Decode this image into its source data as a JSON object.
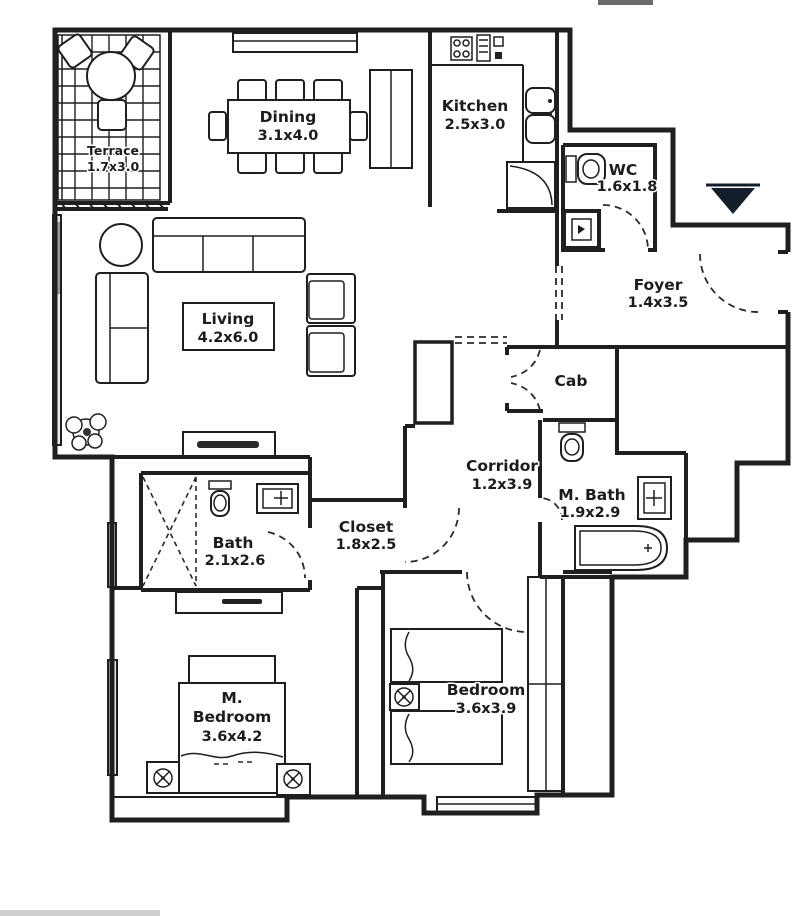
{
  "plan_title": "Apartment floor plan",
  "rooms": {
    "terrace": {
      "name": "Terrace",
      "dims": "1.7x3.0"
    },
    "dining": {
      "name": "Dining",
      "dims": "3.1x4.0"
    },
    "kitchen": {
      "name": "Kitchen",
      "dims": "2.5x3.0"
    },
    "wc": {
      "name": "WC",
      "dims": "1.6x1.8"
    },
    "foyer": {
      "name": "Foyer",
      "dims": "1.4x3.5"
    },
    "living": {
      "name": "Living",
      "dims": "4.2x6.0"
    },
    "cab": {
      "name": "Cab"
    },
    "corridor": {
      "name": "Corridor",
      "dims": "1.2x3.9"
    },
    "master_bath": {
      "name": "M. Bath",
      "dims": "1.9x2.9"
    },
    "bath": {
      "name": "Bath",
      "dims": "2.1x2.6"
    },
    "closet": {
      "name": "Closet",
      "dims": "1.8x2.5"
    },
    "master_bedroom": {
      "line1": "M.",
      "line2": "Bedroom",
      "dims": "3.6x4.2"
    },
    "bedroom": {
      "name": "Bedroom",
      "dims": "3.6x3.9"
    }
  },
  "colors": {
    "wall": "#1f1f1f",
    "entrance_marker": "#151f2b",
    "window_fill": "#e9e9e9",
    "background": "#ffffff"
  }
}
